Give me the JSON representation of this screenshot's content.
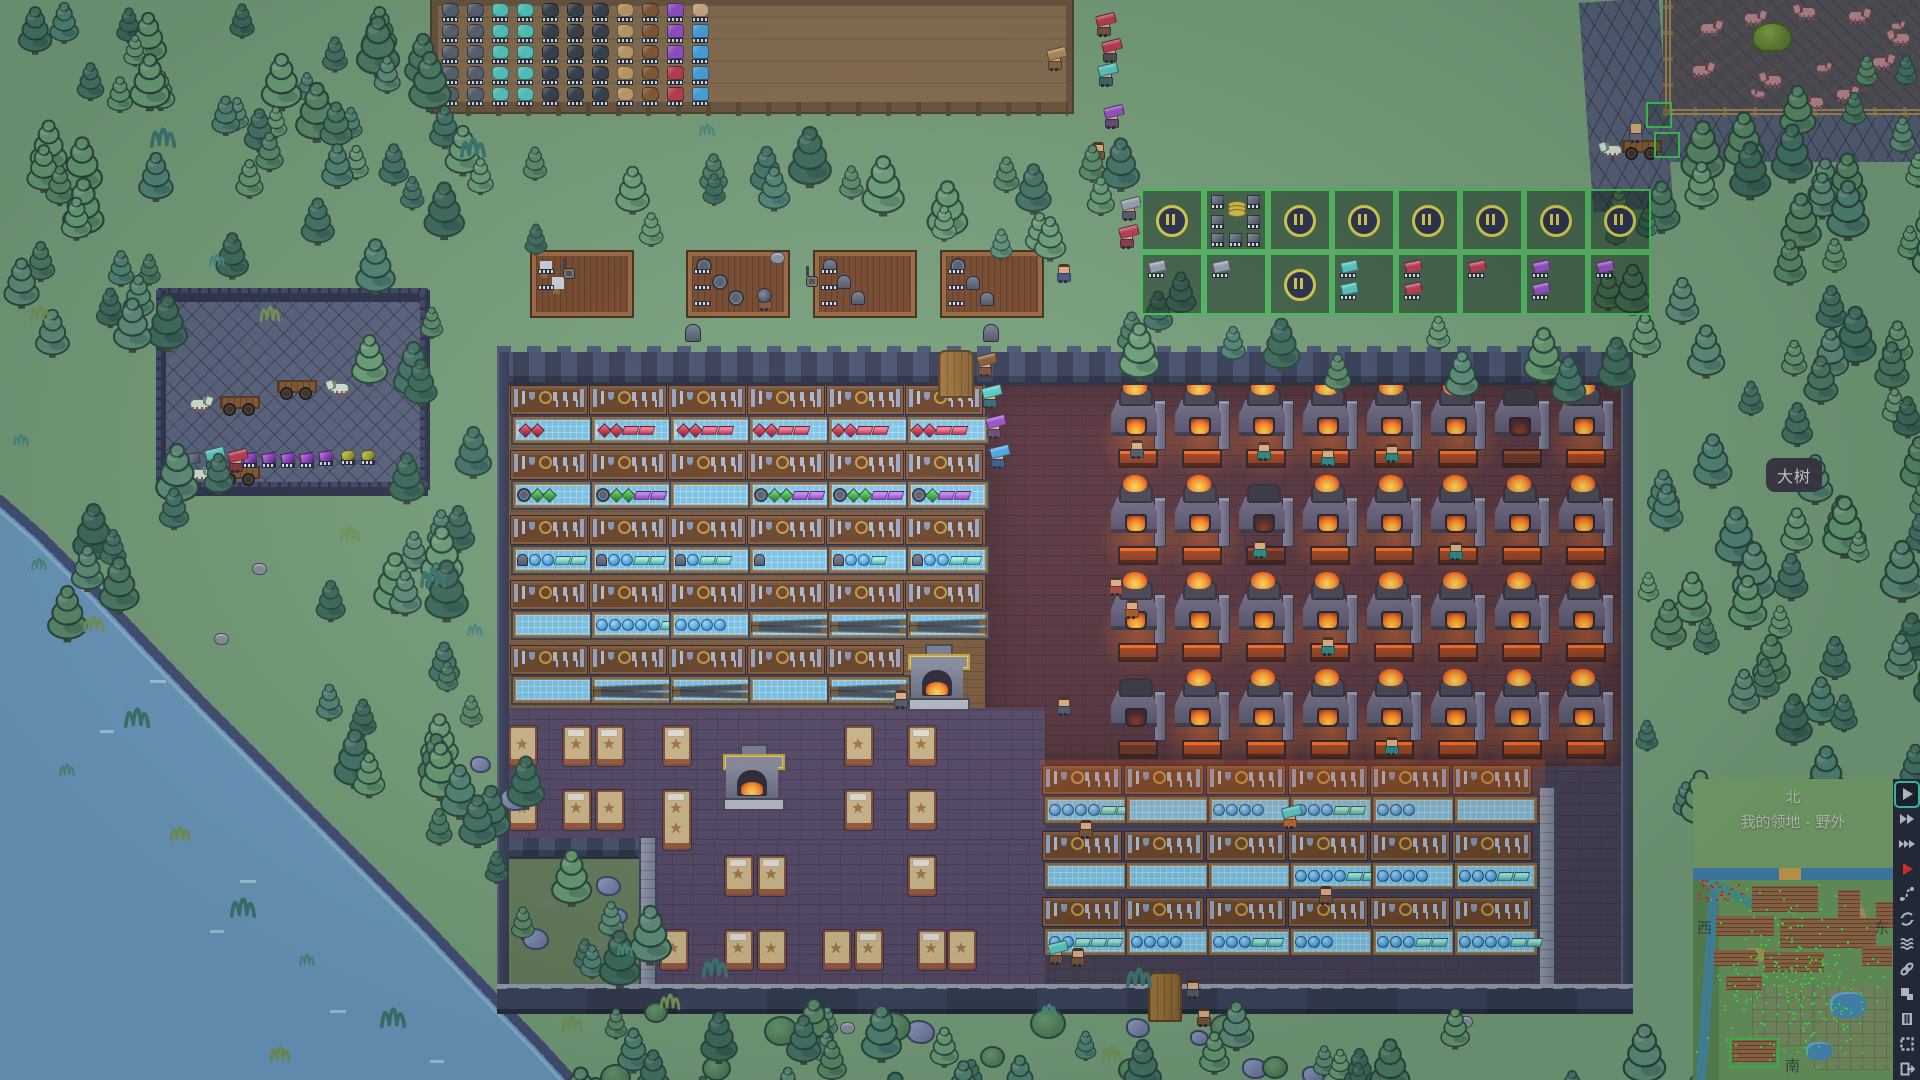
{
  "ui": {
    "tooltip": {
      "text": "大树"
    },
    "minimap": {
      "title_north": "北",
      "subtitle": "我的领地 - 野外",
      "label_west": "西",
      "label_east": "东",
      "label_south": "南",
      "band_color": "#7ea771",
      "river_color": "#4584b4",
      "land_color": "#6f9b62",
      "tree_dot_color": "#39f03e",
      "alert_dot_color": "#ff1f10"
    },
    "sidebar_icons": [
      {
        "name": "play",
        "selected": true
      },
      {
        "name": "fast-forward-2",
        "selected": false
      },
      {
        "name": "fast-forward-3",
        "selected": false
      },
      {
        "name": "play-red",
        "selected": false
      },
      {
        "name": "route",
        "selected": false
      },
      {
        "name": "cycle",
        "selected": false
      },
      {
        "name": "waves",
        "selected": false
      },
      {
        "name": "link",
        "selected": false
      },
      {
        "name": "layout",
        "selected": false
      },
      {
        "name": "film",
        "selected": false
      },
      {
        "name": "frame",
        "selected": false
      },
      {
        "name": "exit",
        "selected": false
      }
    ],
    "production_grid": {
      "border_color": "#3ecb52",
      "pause_color": "#d8d24a",
      "origin": [
        1141,
        189
      ],
      "pitch": 64,
      "rows": [
        [
          {
            "t": "pause"
          },
          {
            "t": "stock"
          },
          {
            "t": "pause"
          },
          {
            "t": "pause"
          },
          {
            "t": "pause"
          },
          {
            "t": "pause"
          },
          {
            "t": "pause"
          },
          {
            "t": "pause"
          }
        ],
        [
          {
            "t": "ing",
            "c": "#9aa2b4",
            "n": 1
          },
          {
            "t": "ing",
            "c": "#9aa2b4",
            "n": 1
          },
          {
            "t": "pause"
          },
          {
            "t": "ing",
            "c": "#57cfc9",
            "n": 2
          },
          {
            "t": "ing",
            "c": "#c43b55",
            "n": 2
          },
          {
            "t": "ing",
            "c": "#c43b55",
            "n": 1
          },
          {
            "t": "ing",
            "c": "#9b4fd0",
            "n": 2
          },
          {
            "t": "ing",
            "c": "#9b4fd0",
            "n": 1
          }
        ]
      ]
    }
  },
  "scene": {
    "farm": {
      "rect": [
        432,
        0,
        640,
        112
      ],
      "grid_origin": [
        442,
        3
      ],
      "col_types": [
        "ore",
        "ore",
        "crystal",
        "crystal",
        "coal",
        "coal",
        "coal",
        "leather",
        "pelt",
        "purple",
        "blue"
      ],
      "rows": 5,
      "overrides": {
        "3,9": "red",
        "4,9": "red",
        "0,10": "bread"
      }
    },
    "racks": [
      {
        "x": 532,
        "y": 252,
        "items": [
          "sword",
          "sword"
        ]
      },
      {
        "x": 688,
        "y": 252,
        "items": [
          "disc",
          "disc",
          "disc"
        ]
      },
      {
        "x": 815,
        "y": 252,
        "items": [
          "helm",
          "helm",
          "helm"
        ]
      },
      {
        "x": 942,
        "y": 252,
        "items": [
          "disc",
          "helm",
          "helm"
        ]
      }
    ],
    "lamps": [
      [
        563,
        258
      ],
      [
        806,
        266
      ]
    ],
    "ground_helms": [
      [
        685,
        324
      ],
      [
        983,
        324
      ]
    ],
    "stable": {
      "rect": [
        162,
        296,
        262,
        192
      ],
      "wagons": [
        [
          190,
          396,
          1
        ],
        [
          283,
          380,
          -1
        ],
        [
          190,
          466,
          1
        ]
      ],
      "gems": [
        [
          243,
          453
        ],
        [
          262,
          453
        ],
        [
          281,
          453
        ],
        [
          300,
          453
        ],
        [
          319,
          451
        ]
      ],
      "spools": [
        [
          341,
          450
        ],
        [
          361,
          450
        ]
      ],
      "ore": [
        186,
        453
      ]
    },
    "merchant_cart": [
      1596,
      134
    ],
    "paddock": {
      "rect": [
        1663,
        0,
        257,
        113
      ],
      "horses": [
        [
          1700,
          20,
          1,
          1
        ],
        [
          1744,
          10,
          1,
          1
        ],
        [
          1790,
          4,
          -1,
          1
        ],
        [
          1848,
          8,
          1,
          1
        ],
        [
          1884,
          30,
          -1,
          1
        ],
        [
          1692,
          62,
          1,
          1
        ],
        [
          1756,
          72,
          -1,
          1
        ],
        [
          1836,
          86,
          1,
          1
        ],
        [
          1872,
          54,
          1,
          1
        ],
        [
          1798,
          94,
          -1,
          1
        ],
        [
          1812,
          60,
          1,
          0.68
        ],
        [
          1744,
          86,
          -1,
          0.62
        ],
        [
          1886,
          18,
          1,
          0.6
        ]
      ],
      "hay": [
        1752,
        22
      ]
    },
    "building": {
      "rect": [
        497,
        352,
        1136,
        662
      ],
      "workshop_shelves": {
        "origin": [
          511,
          386
        ],
        "pitch": [
          79,
          65
        ],
        "unit_w": 76,
        "rows": [
          [
            "sword,gemR,gemR",
            "sword,gemR,gemR,ingR,ingR",
            "sword,gemR,gemR,ingR,ingR",
            "gemR,gemR,ingR,ingR",
            "gemR,gemR,ingR,ingR",
            "gemR,gemR,ingR,ingR"
          ],
          [
            "disc,gemG,gemG",
            "disc,gemG,gemG,ingP,ingP",
            "",
            "disc,gemG,gemG,ingP,ingP",
            "disc,gemG,gemG,ingP,ingP",
            "disc,gemG,ingP,ingP"
          ],
          [
            "helm,orb,orb,ingT,ingT",
            "helm,orb,orb,ingT,ingT",
            "helm,orb,ingT,ingT",
            "helm",
            "helm,orb,orb,ingT",
            "helm,orb,orb,ingT,ingT"
          ],
          [
            "",
            "orb,orb,orb,orb,orb,ingT,ingT",
            "orb,orb,orb,orb",
            "beam",
            "beam",
            "beam"
          ],
          [
            "",
            "beam",
            "beam",
            "",
            "beam",
            null
          ]
        ]
      },
      "south_shelves": {
        "origin": [
          1043,
          766
        ],
        "pitch": [
          82,
          66
        ],
        "unit_w": 78,
        "rows": [
          [
            "orb,orb,orb,orb,ingT,ingT,ingT",
            "",
            "orb,orb,orb,orb",
            "orb,orb,orb,ingT,ingT",
            "orb,orb,orb",
            ""
          ],
          [
            "",
            "",
            "",
            "orb,orb,orb,orb,ingT,ingT",
            "orb,orb,orb,orb",
            "orb,orb,orb,ingT,ingT"
          ],
          [
            "orb,orb,ingT,ingT,ingT",
            "orb,orb,orb,orb",
            "orb,orb,orb,ingT,ingT",
            "orb,orb,orb",
            "orb,orb,orb,ingT,ingT",
            "orb,orb,orb,orb,ingT,ingT"
          ]
        ]
      },
      "furnaces": {
        "origin": [
          1110,
          385
        ],
        "pitch": [
          64,
          97
        ],
        "cols": 8,
        "rows": 4,
        "off": [
          [
            0,
            6
          ],
          [
            1,
            2
          ],
          [
            3,
            0
          ]
        ]
      },
      "beds": [
        [
          509,
          726,
          "s"
        ],
        [
          563,
          726,
          "ps"
        ],
        [
          596,
          726,
          "ps"
        ],
        [
          663,
          726,
          "ps"
        ],
        [
          845,
          726,
          "s"
        ],
        [
          908,
          726,
          "ps"
        ],
        [
          509,
          790,
          "ps"
        ],
        [
          563,
          790,
          "ps"
        ],
        [
          596,
          790,
          "s"
        ],
        [
          663,
          790,
          "t"
        ],
        [
          845,
          790,
          "ps"
        ],
        [
          908,
          790,
          "s"
        ],
        [
          725,
          856,
          "ps"
        ],
        [
          758,
          856,
          "ps"
        ],
        [
          908,
          856,
          "ps"
        ],
        [
          660,
          930,
          "s"
        ],
        [
          725,
          930,
          "ps"
        ],
        [
          758,
          930,
          "s"
        ],
        [
          823,
          930,
          "s"
        ],
        [
          855,
          930,
          "ps"
        ],
        [
          918,
          930,
          "ps"
        ],
        [
          948,
          930,
          "s"
        ]
      ],
      "fireplaces": [
        {
          "x": 908,
          "y": 646,
          "gold": true
        },
        {
          "x": 723,
          "y": 746,
          "gold": true
        }
      ],
      "doors": [
        [
          938,
          350,
          32,
          44
        ],
        [
          1148,
          972,
          30,
          46
        ]
      ]
    },
    "villagers": [
      [
        1096,
        14,
        "#7a5340",
        "ingR"
      ],
      [
        1102,
        40,
        "#5a4a58",
        "ingR"
      ],
      [
        1098,
        64,
        "#3a6a72",
        "ingT"
      ],
      [
        1104,
        106,
        "#6a4a78",
        "ingP"
      ],
      [
        1090,
        138,
        "#7a5340",
        ""
      ],
      [
        1047,
        48,
        "#8a6a4a",
        "sack"
      ],
      [
        1121,
        198,
        "#5a5a6a",
        "ingGy"
      ],
      [
        1119,
        226,
        "#8a3a4a",
        "ingR"
      ],
      [
        1056,
        260,
        "#4a5a8a",
        ""
      ],
      [
        757,
        288,
        "#8a5a3a",
        "disc"
      ],
      [
        977,
        354,
        "#7a5340",
        "log"
      ],
      [
        982,
        386,
        "#3a6a72",
        "ingT"
      ],
      [
        986,
        416,
        "#6a4a78",
        "ingP"
      ],
      [
        990,
        446,
        "#3a5a8a",
        "gemB"
      ],
      [
        1129,
        436,
        "#555a6a",
        ""
      ],
      [
        1256,
        438,
        "#2e8a84",
        ""
      ],
      [
        1320,
        444,
        "#2e8a84",
        ""
      ],
      [
        1384,
        440,
        "#2e8a84",
        ""
      ],
      [
        1252,
        536,
        "#2e8a84",
        ""
      ],
      [
        1448,
        538,
        "#2e8a84",
        ""
      ],
      [
        1320,
        633,
        "#2e8a84",
        ""
      ],
      [
        1384,
        733,
        "#2e8a84",
        ""
      ],
      [
        1108,
        573,
        "#a84a3a",
        ""
      ],
      [
        1124,
        596,
        "#a85a2a",
        ""
      ],
      [
        893,
        686,
        "#555a6a",
        ""
      ],
      [
        1056,
        693,
        "#555a6a",
        ""
      ],
      [
        1282,
        806,
        "#b86a3a",
        "ingT"
      ],
      [
        1078,
        816,
        "#7a5340",
        ""
      ],
      [
        1318,
        882,
        "#7a5340",
        ""
      ],
      [
        1048,
        942,
        "#7a5340",
        "ingT"
      ],
      [
        1070,
        944,
        "#7a5340",
        ""
      ],
      [
        1185,
        976,
        "#555a6a",
        ""
      ],
      [
        1196,
        1004,
        "#7a5340",
        ""
      ],
      [
        205,
        448,
        "#3a6a72",
        "ingT"
      ],
      [
        228,
        450,
        "#8a3a4a",
        "ingR"
      ]
    ],
    "tree_regions": [
      [
        0,
        0,
        430,
        118,
        26
      ],
      [
        0,
        110,
        150,
        200,
        12
      ],
      [
        175,
        115,
        250,
        135,
        10
      ],
      [
        55,
        250,
        110,
        70,
        4
      ],
      [
        430,
        115,
        630,
        115,
        15
      ],
      [
        340,
        250,
        150,
        320,
        13
      ],
      [
        295,
        555,
        195,
        205,
        12
      ],
      [
        420,
        750,
        130,
        170,
        8
      ],
      [
        1632,
        55,
        288,
        730,
        62
      ],
      [
        1560,
        155,
        115,
        185,
        8
      ],
      [
        1680,
        108,
        235,
        95,
        9
      ],
      [
        555,
        995,
        1150,
        85,
        34
      ],
      [
        525,
        855,
        110,
        115,
        5
      ],
      [
        900,
        128,
        250,
        105,
        8
      ],
      [
        1095,
        240,
        70,
        105,
        4
      ],
      [
        1140,
        315,
        470,
        45,
        8
      ],
      [
        0,
        470,
        110,
        120,
        5
      ],
      [
        150,
        420,
        60,
        80,
        3
      ]
    ],
    "tree_palette": [
      "#5e8f6c",
      "#4f8068",
      "#6aa076",
      "#54897a",
      "#47786b",
      "#70a47c",
      "#3f6f60",
      "#62937e"
    ],
    "rocks": [
      [
        566,
        886
      ],
      [
        596,
        876
      ],
      [
        608,
        908
      ],
      [
        522,
        928
      ],
      [
        870,
        1013
      ],
      [
        906,
        1020
      ],
      [
        1126,
        1018
      ],
      [
        1190,
        1030
      ],
      [
        1242,
        1058
      ],
      [
        470,
        756
      ],
      [
        500,
        788
      ],
      [
        1302,
        1066
      ]
    ],
    "bushes": [
      [
        644,
        1002
      ],
      [
        702,
        1056
      ],
      [
        764,
        1016
      ],
      [
        980,
        1046
      ],
      [
        1210,
        1014
      ],
      [
        876,
        1012
      ],
      [
        1262,
        1056
      ],
      [
        600,
        1064
      ],
      [
        1030,
        1008
      ],
      [
        1118,
        1058
      ]
    ],
    "tufts": [
      [
        30,
        552
      ],
      [
        82,
        608
      ],
      [
        122,
        698
      ],
      [
        58,
        758
      ],
      [
        168,
        818
      ],
      [
        228,
        888
      ],
      [
        298,
        948
      ],
      [
        658,
        986
      ],
      [
        700,
        948
      ],
      [
        1040,
        998
      ],
      [
        1100,
        1038
      ],
      [
        1124,
        958
      ],
      [
        208,
        248
      ],
      [
        258,
        298
      ],
      [
        458,
        128
      ],
      [
        698,
        118
      ],
      [
        28,
        298
      ],
      [
        148,
        118
      ],
      [
        12,
        428
      ],
      [
        338,
        518
      ],
      [
        418,
        558
      ],
      [
        466,
        618
      ],
      [
        268,
        1038
      ],
      [
        378,
        998
      ],
      [
        616,
        938
      ],
      [
        560,
        1008
      ]
    ],
    "stumps": [
      [
        252,
        563
      ],
      [
        214,
        633
      ],
      [
        840,
        1022
      ],
      [
        1458,
        1016
      ],
      [
        770,
        252
      ]
    ],
    "select_boxes": [
      [
        1646,
        102
      ],
      [
        1654,
        132
      ]
    ],
    "minimap_blocks": [
      [
        1752,
        886,
        66,
        26
      ],
      [
        1716,
        916,
        58,
        20
      ],
      [
        1780,
        918,
        96,
        30
      ],
      [
        1714,
        950,
        44,
        16
      ],
      [
        1764,
        952,
        60,
        20
      ],
      [
        1726,
        976,
        36,
        14
      ],
      [
        1732,
        1040,
        44,
        22
      ],
      [
        1838,
        890,
        22,
        34
      ],
      [
        1876,
        902,
        20,
        26
      ],
      [
        1862,
        946,
        30,
        20
      ]
    ],
    "minimap_grids": [
      [
        1752,
        986,
        74,
        60
      ],
      [
        1814,
        986,
        76,
        84
      ]
    ],
    "minimap_sand": [
      [
        1840,
        905,
        26,
        40
      ],
      [
        1745,
        948,
        20,
        14
      ],
      [
        1868,
        1028,
        16,
        20
      ]
    ],
    "minimap_lakes": [
      [
        1830,
        992,
        36,
        26
      ],
      [
        1806,
        1042,
        26,
        18
      ]
    ]
  }
}
